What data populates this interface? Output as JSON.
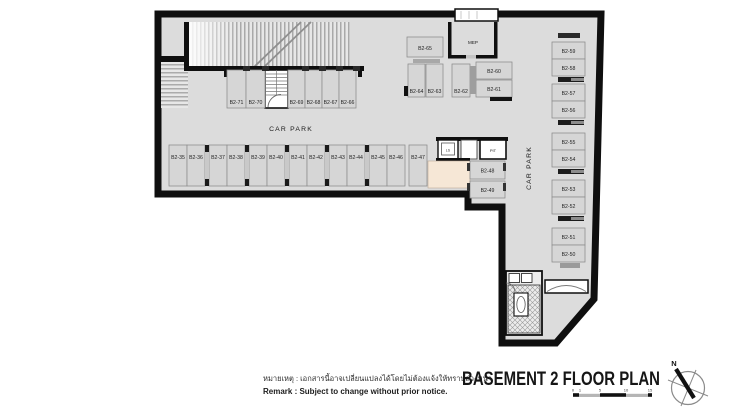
{
  "title": "BASEMENT 2 FLOOR PLAN",
  "remark": {
    "thai": "หมายเหตุ : เอกสารนี้อาจเปลี่ยนแปลงได้โดยไม่ต้องแจ้งให้ทราบล่วงหน้า",
    "english": "Remark  :  Subject to change without prior notice."
  },
  "zones": {
    "car_park_main": "CAR PARK",
    "car_park_right": "CAR PARK"
  },
  "rooms": {
    "mep": "MEP",
    "pit": "PIT",
    "lift": "LS"
  },
  "compass": {
    "north_label": "N"
  },
  "scale_bar": {
    "tick_labels": [
      "0",
      "1",
      "5",
      "10",
      "15"
    ]
  },
  "parking_spots": {
    "middle_row": [
      "B2-35",
      "B2-36",
      "B2-37",
      "B2-38",
      "B2-39",
      "B2-40",
      "B2-41",
      "B2-42",
      "B2-43",
      "B2-44",
      "B2-45",
      "B2-46",
      "B2-47"
    ],
    "top_row": [
      "B2-71",
      "B2-70",
      "B2-69",
      "B2-68",
      "B2-67",
      "B2-66"
    ],
    "upper_cluster": [
      "B2-65",
      "B2-64",
      "B2-63",
      "B2-62",
      "B2-60",
      "B2-61"
    ],
    "side_pair": [
      "B2-48",
      "B2-49"
    ],
    "right_column": [
      "B2-59",
      "B2-58",
      "B2-57",
      "B2-56",
      "B2-55",
      "B2-54",
      "B2-53",
      "B2-52",
      "B2-51",
      "B2-50"
    ]
  },
  "colors": {
    "floor": "#dcdcdc",
    "wall": "#0f0f0f",
    "spot_fill": "#d6d6d6",
    "spot_border": "#8f8f8f",
    "lobby": "#f6e7d6",
    "room_white": "#ffffff"
  }
}
